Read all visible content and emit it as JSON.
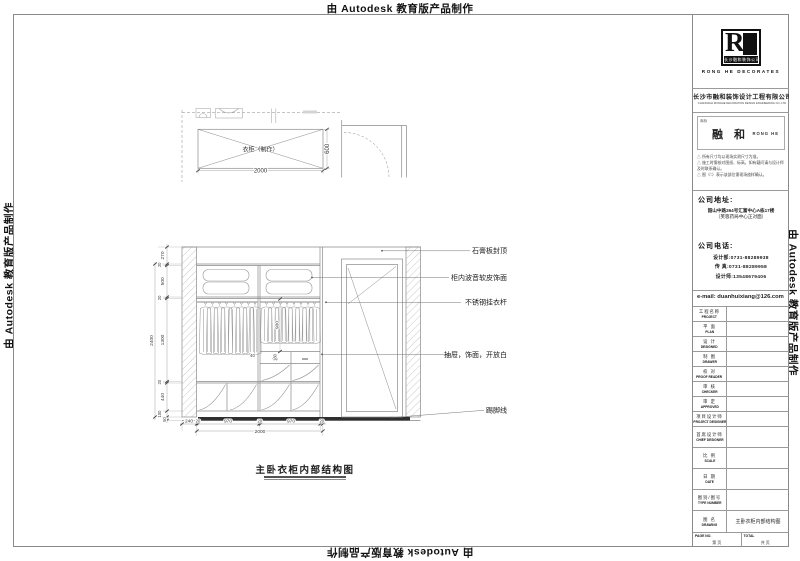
{
  "watermark": {
    "text": "由 Autodesk 教育版产品制作"
  },
  "plan": {
    "label": "衣柜（制作）",
    "dim_width": "2000",
    "dim_depth": "600"
  },
  "elevation": {
    "left_chain": [
      "270",
      "20",
      "500",
      "20",
      "1300",
      "20",
      "440",
      "100",
      "50"
    ],
    "overall_height": "2400",
    "bottom_chain": [
      "240",
      "20",
      "970",
      "20",
      "970",
      "20"
    ],
    "overall_width": "2000",
    "dim_hang": "900",
    "dim_drawer_gap": "40",
    "dim_drawer": "180",
    "callouts": [
      "石膏板封顶",
      "柜内波音软皮饰面",
      "不锈钢挂衣杆",
      "抽屉，饰面，开放白",
      "踢脚线"
    ]
  },
  "drawing_title": "主卧衣柜内部结构图",
  "titleblock": {
    "logo": {
      "monogram": "R",
      "strip": "长沙融和装饰公司",
      "subtitle": "RONG HE DECORATES"
    },
    "company": {
      "name_cn": "长沙市融和装饰设计工程有限公司",
      "name_en": "CHANGSHA RONGHE DECORATION DESIGN ENGINEERING CO.,LTD"
    },
    "stamp": {
      "field": "商标",
      "name": "融 和",
      "name_en": "RONG HE"
    },
    "notes": [
      "△ 所有尺寸均以现场实测尺寸为准。",
      "△ 施工时需核对图纸、标高，如有疑问请与设计师及时联系确认。",
      "△ 图（□）表示该部位需现场放样确认。"
    ],
    "address": {
      "label": "公司地址:",
      "line1": "韶山中路264号汇富中心A栋17楼",
      "line2": "（芙蓉药局中心正对面）"
    },
    "phone": {
      "label": "公司电话:",
      "lines": [
        "设计部:0731-88289938",
        "传 真:0731-88289958",
        "设计师:13548679406"
      ]
    },
    "email": "e-mail: duanhuixiang@126.com",
    "rows": [
      {
        "zh": "工程名称",
        "en": "PROJECT"
      },
      {
        "zh": "平 面",
        "en": "PLAN"
      },
      {
        "zh": "设 计",
        "en": "DESIGNED"
      },
      {
        "zh": "制 图",
        "en": "DRAWER"
      },
      {
        "zh": "校 对",
        "en": "PROOF READER"
      },
      {
        "zh": "审 核",
        "en": "CHECKER"
      },
      {
        "zh": "审 定",
        "en": "APPROVED"
      },
      {
        "zh": "项目设计师",
        "en": "PROJECT DESIGNER"
      },
      {
        "zh": "首席设计师",
        "en": "CHIEF DESIGNER"
      },
      {
        "zh": "比 例",
        "en": "SCALE"
      },
      {
        "zh": "日 期",
        "en": "DATE"
      },
      {
        "zh": "图别/图号",
        "en": "TYPE NUMBER"
      },
      {
        "zh": "图 名",
        "en": "DRAWING"
      }
    ],
    "drawing_name_value": "主卧衣柜内部结构图",
    "page": {
      "label": "PAGE NO.",
      "value": "第  页"
    },
    "total": {
      "label": "TOTAL",
      "value": "共  页"
    }
  }
}
